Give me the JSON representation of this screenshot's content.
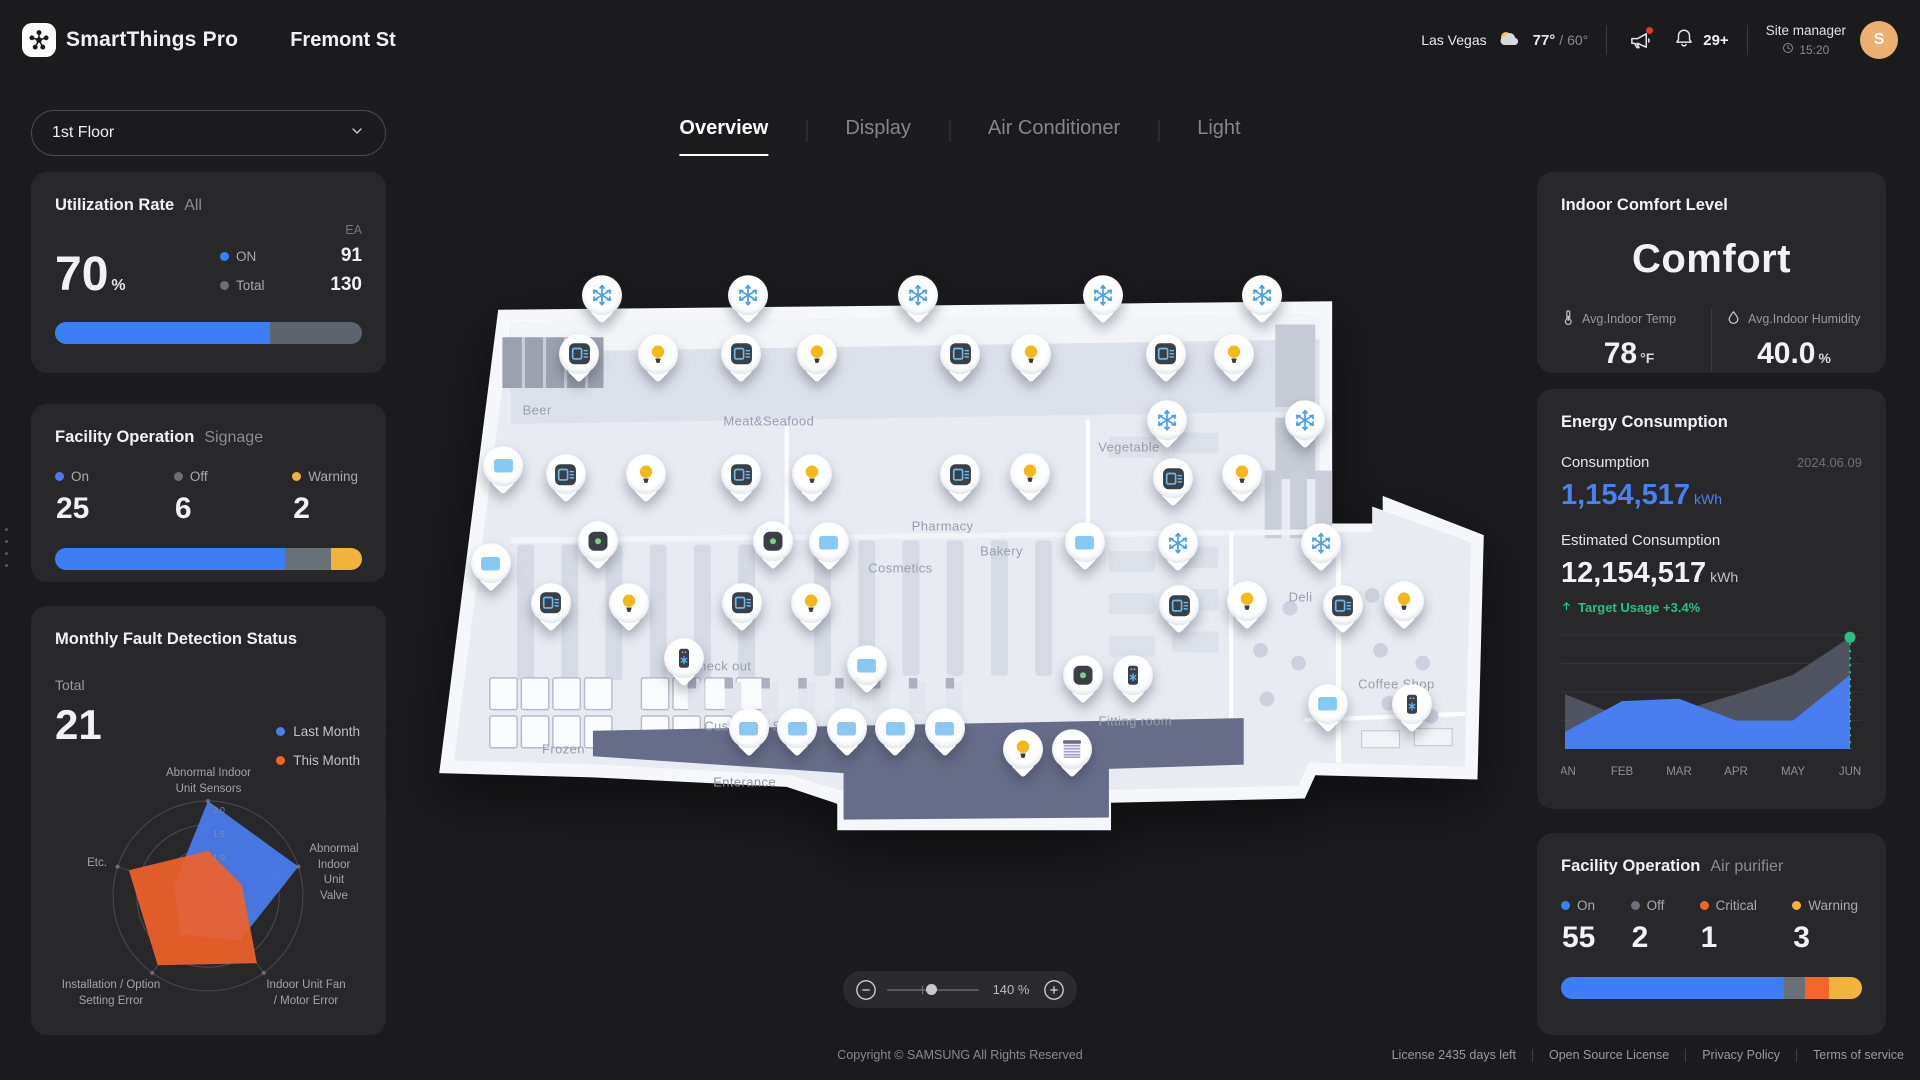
{
  "theme": {
    "accent_blue": "#3D7EF7",
    "neutral_gray": "#697077",
    "warning_yellow": "#F1B33C",
    "critical_orange": "#F4662A",
    "success_green": "#27C281",
    "avatar_orange": "#EDAF6F",
    "card_bg": "#28282B",
    "page_bg": "#1B1B1D"
  },
  "header": {
    "brand": "SmartThings Pro",
    "site_title": "Fremont St",
    "weather": {
      "city": "Las Vegas",
      "temp_high": "77°",
      "temp_low": "/ 60°",
      "icon": "partly-cloudy-icon"
    },
    "announcement_icon": "megaphone-icon",
    "notifications": {
      "icon": "bell-icon",
      "badge": "29+"
    },
    "profile": {
      "role": "Site manager",
      "time_icon": "clock-icon",
      "time": "15:20",
      "avatar_initial": "S"
    }
  },
  "floor_selector": {
    "value": "1st Floor",
    "icon": "chevron-down-icon"
  },
  "tabs": [
    {
      "label": "Overview",
      "active": true
    },
    {
      "label": "Display",
      "active": false
    },
    {
      "label": "Air Conditioner",
      "active": false
    },
    {
      "label": "Light",
      "active": false
    }
  ],
  "utilization_card": {
    "title": "Utilization Rate",
    "scope": "All",
    "unit_label": "EA",
    "percent_value": "70",
    "percent_unit": "%",
    "legend": [
      {
        "label": "ON",
        "value": "91",
        "color": "#3D7EF7"
      },
      {
        "label": "Total",
        "value": "130",
        "color": "#697077"
      }
    ],
    "bar": {
      "fill_percent": 70,
      "fill_color": "#3D7EF7"
    }
  },
  "signage_card": {
    "title": "Facility Operation",
    "scope": "Signage",
    "stats": [
      {
        "label": "On",
        "value": "25",
        "color": "#3D7EF7",
        "width": 75
      },
      {
        "label": "Off",
        "value": "6",
        "color": "#697077",
        "width": 15
      },
      {
        "label": "Warning",
        "value": "2",
        "color": "#F1B33C",
        "width": 10
      }
    ]
  },
  "fault_card": {
    "title": "Monthly Fault Detection Status",
    "total_label": "Total",
    "total_value": "21",
    "legend": [
      {
        "label": "Last Month",
        "color": "#4A7DF0"
      },
      {
        "label": "This Month",
        "color": "#F0622A"
      }
    ],
    "chart_data": {
      "type": "radar",
      "axes": [
        "Abnormal Indoor\nUnit Sensors",
        "Abnormal\nIndoor Unit\nValve",
        "Indoor Unit Fan\n/ Motor Error",
        "Installation / Option\nSetting Error",
        "Etc."
      ],
      "ring_labels": [
        "1.0",
        "1.5",
        "2.0"
      ],
      "max": 2.0,
      "series": [
        {
          "name": "Last Month",
          "color": "#4A7DF0",
          "values": [
            2.0,
            2.0,
            1.15,
            1.0,
            0.75
          ]
        },
        {
          "name": "This Month",
          "color": "#F0622A",
          "values": [
            0.95,
            0.75,
            1.75,
            1.8,
            1.75
          ]
        }
      ]
    }
  },
  "comfort_card": {
    "title": "Indoor Comfort Level",
    "level": "Comfort",
    "metrics": [
      {
        "icon": "thermometer-icon",
        "label": "Avg.Indoor Temp",
        "value": "78",
        "unit": "°F"
      },
      {
        "icon": "humidity-icon",
        "label": "Avg.Indoor Humidity",
        "value": "40.0",
        "unit": "%"
      }
    ]
  },
  "energy_card": {
    "title": "Energy Consumption",
    "consumption_label": "Consumption",
    "date": "2024.06.09",
    "consumption_value": "1,154,517",
    "consumption_unit": "kWh",
    "estimated_label": "Estimated Consumption",
    "estimated_value": "12,154,517",
    "estimated_unit": "kWh",
    "target_icon": "arrow-up-icon",
    "target_text": "Target Usage +3.4%",
    "chart_data": {
      "type": "area",
      "x": [
        "JAN",
        "FEB",
        "MAR",
        "APR",
        "MAY",
        "JUN"
      ],
      "series": [
        {
          "name": "Estimated",
          "color": "#555B68",
          "values": [
            48,
            28,
            33,
            48,
            65,
            98
          ]
        },
        {
          "name": "Consumption",
          "color": "#4A7DF0",
          "values": [
            15,
            42,
            44,
            25,
            25,
            65
          ]
        }
      ],
      "marker": {
        "x_index": 5,
        "value": 98,
        "color": "#27C281"
      },
      "grid": true,
      "ylim": [
        0,
        100
      ]
    }
  },
  "purifier_card": {
    "title": "Facility Operation",
    "scope": "Air purifier",
    "stats": [
      {
        "label": "On",
        "value": "55",
        "color": "#3D7EF7",
        "width": 74
      },
      {
        "label": "Off",
        "value": "2",
        "color": "#697077",
        "width": 7
      },
      {
        "label": "Critical",
        "value": "1",
        "color": "#F4662A",
        "width": 8
      },
      {
        "label": "Warning",
        "value": "3",
        "color": "#F1B33C",
        "width": 11
      }
    ]
  },
  "map": {
    "regions": [
      {
        "label": "Beer",
        "x": 9.7,
        "y": 23.3,
        "dark": false
      },
      {
        "label": "Meat&Seafood",
        "x": 31.7,
        "y": 25.2,
        "dark": false
      },
      {
        "label": "Vegetable",
        "x": 65.9,
        "y": 29.8,
        "dark": false
      },
      {
        "label": "Bakery",
        "x": 53.8,
        "y": 48.3,
        "dark": false
      },
      {
        "label": "Pharmacy",
        "x": 48.2,
        "y": 43.8,
        "dark": false
      },
      {
        "label": "Cosmetics",
        "x": 44.2,
        "y": 51.3,
        "dark": false
      },
      {
        "label": "Deli",
        "x": 82.2,
        "y": 56.3,
        "dark": false
      },
      {
        "label": "Check out",
        "x": 27.1,
        "y": 68.5,
        "dark": false
      },
      {
        "label": "Custormer Service",
        "x": 31.0,
        "y": 79.1,
        "dark": false
      },
      {
        "label": "Frozen",
        "x": 12.2,
        "y": 83.3,
        "dark": false
      },
      {
        "label": "Fitting room",
        "x": 66.5,
        "y": 78.2,
        "dark": false
      },
      {
        "label": "Enterance",
        "x": 29.4,
        "y": 89.1,
        "dark": true
      },
      {
        "label": "Coffee Shop",
        "x": 91.3,
        "y": 71.7,
        "dark": false
      }
    ],
    "pins": [
      {
        "type": "snow",
        "icon": "snowflake-icon",
        "x": 15.9,
        "y": 7.6
      },
      {
        "type": "snow",
        "icon": "snowflake-icon",
        "x": 29.7,
        "y": 7.6
      },
      {
        "type": "snow",
        "icon": "snowflake-icon",
        "x": 45.9,
        "y": 7.6
      },
      {
        "type": "snow",
        "icon": "snowflake-icon",
        "x": 63.4,
        "y": 7.6
      },
      {
        "type": "snow",
        "icon": "snowflake-icon",
        "x": 78.5,
        "y": 7.6
      },
      {
        "type": "snow",
        "icon": "snowflake-icon",
        "x": 69.5,
        "y": 29.6
      },
      {
        "type": "snow",
        "icon": "snowflake-icon",
        "x": 82.6,
        "y": 29.6
      },
      {
        "type": "snow",
        "icon": "snowflake-icon",
        "x": 70.6,
        "y": 51.5
      },
      {
        "type": "snow",
        "icon": "snowflake-icon",
        "x": 84.1,
        "y": 51.5
      },
      {
        "type": "ac",
        "icon": "ac-unit-icon",
        "x": 13.7,
        "y": 18.0
      },
      {
        "type": "ac",
        "icon": "ac-unit-icon",
        "x": 29.1,
        "y": 18.0
      },
      {
        "type": "ac",
        "icon": "ac-unit-icon",
        "x": 49.9,
        "y": 18.0
      },
      {
        "type": "ac",
        "icon": "ac-unit-icon",
        "x": 69.4,
        "y": 18.0
      },
      {
        "type": "ac",
        "icon": "ac-unit-icon",
        "x": 12.4,
        "y": 39.3
      },
      {
        "type": "ac",
        "icon": "ac-unit-icon",
        "x": 29.1,
        "y": 39.3
      },
      {
        "type": "ac",
        "icon": "ac-unit-icon",
        "x": 49.9,
        "y": 39.3
      },
      {
        "type": "ac",
        "icon": "ac-unit-icon",
        "x": 70.1,
        "y": 40.0
      },
      {
        "type": "ac",
        "icon": "ac-unit-icon",
        "x": 11.0,
        "y": 62.0
      },
      {
        "type": "ac",
        "icon": "ac-unit-icon",
        "x": 29.2,
        "y": 62.0
      },
      {
        "type": "ac",
        "icon": "ac-unit-icon",
        "x": 70.7,
        "y": 62.4
      },
      {
        "type": "ac",
        "icon": "ac-unit-icon",
        "x": 86.2,
        "y": 62.4
      },
      {
        "type": "light",
        "icon": "bulb-icon",
        "x": 21.2,
        "y": 18.0
      },
      {
        "type": "light",
        "icon": "bulb-icon",
        "x": 36.3,
        "y": 18.0
      },
      {
        "type": "light",
        "icon": "bulb-icon",
        "x": 56.6,
        "y": 18.0
      },
      {
        "type": "light",
        "icon": "bulb-icon",
        "x": 75.9,
        "y": 18.0
      },
      {
        "type": "light",
        "icon": "bulb-icon",
        "x": 20.0,
        "y": 39.3
      },
      {
        "type": "light",
        "icon": "bulb-icon",
        "x": 35.8,
        "y": 39.3
      },
      {
        "type": "light",
        "icon": "bulb-icon",
        "x": 56.5,
        "y": 39.1
      },
      {
        "type": "light",
        "icon": "bulb-icon",
        "x": 76.6,
        "y": 39.3
      },
      {
        "type": "light",
        "icon": "bulb-icon",
        "x": 18.4,
        "y": 62.0
      },
      {
        "type": "light",
        "icon": "bulb-icon",
        "x": 35.7,
        "y": 62.0
      },
      {
        "type": "light",
        "icon": "bulb-icon",
        "x": 77.1,
        "y": 61.7
      },
      {
        "type": "light",
        "icon": "bulb-icon",
        "x": 92.0,
        "y": 61.7
      },
      {
        "type": "light",
        "icon": "bulb-icon",
        "x": 55.8,
        "y": 87.8
      },
      {
        "type": "display",
        "icon": "display-icon",
        "x": 6.5,
        "y": 37.8
      },
      {
        "type": "display",
        "icon": "display-icon",
        "x": 5.3,
        "y": 55.0
      },
      {
        "type": "display",
        "icon": "display-icon",
        "x": 37.4,
        "y": 51.3
      },
      {
        "type": "display",
        "icon": "display-icon",
        "x": 61.7,
        "y": 51.3
      },
      {
        "type": "display",
        "icon": "display-icon",
        "x": 41.0,
        "y": 73.0
      },
      {
        "type": "display",
        "icon": "display-icon",
        "x": 84.8,
        "y": 79.8
      },
      {
        "type": "display",
        "icon": "display-icon",
        "x": 29.8,
        "y": 84.1
      },
      {
        "type": "display",
        "icon": "display-icon",
        "x": 34.4,
        "y": 84.1
      },
      {
        "type": "display",
        "icon": "display-icon",
        "x": 39.1,
        "y": 84.1
      },
      {
        "type": "display",
        "icon": "display-icon",
        "x": 43.7,
        "y": 84.1
      },
      {
        "type": "display",
        "icon": "display-icon",
        "x": 48.4,
        "y": 84.1
      },
      {
        "type": "sensor",
        "icon": "sensor-icon",
        "x": 15.5,
        "y": 51.1
      },
      {
        "type": "sensor",
        "icon": "sensor-icon",
        "x": 32.1,
        "y": 51.1
      },
      {
        "type": "sensor",
        "icon": "sensor-icon",
        "x": 61.5,
        "y": 74.8
      },
      {
        "type": "purifier",
        "icon": "air-purifier-icon",
        "x": 23.6,
        "y": 71.7
      },
      {
        "type": "purifier",
        "icon": "air-purifier-icon",
        "x": 66.3,
        "y": 74.8
      },
      {
        "type": "purifier",
        "icon": "air-purifier-icon",
        "x": 92.8,
        "y": 79.8
      },
      {
        "type": "blind",
        "icon": "blind-icon",
        "x": 60.5,
        "y": 87.8
      }
    ],
    "zoom": {
      "minus_icon": "zoom-out-icon",
      "plus_icon": "zoom-in-icon",
      "value": "140 %",
      "slider_percent": 42
    }
  },
  "footer": {
    "copyright": "Copyright © SAMSUNG All Rights Reserved",
    "links": [
      "License 2435 days left",
      "Open Source License",
      "Privacy Policy",
      "Terms of service"
    ]
  }
}
